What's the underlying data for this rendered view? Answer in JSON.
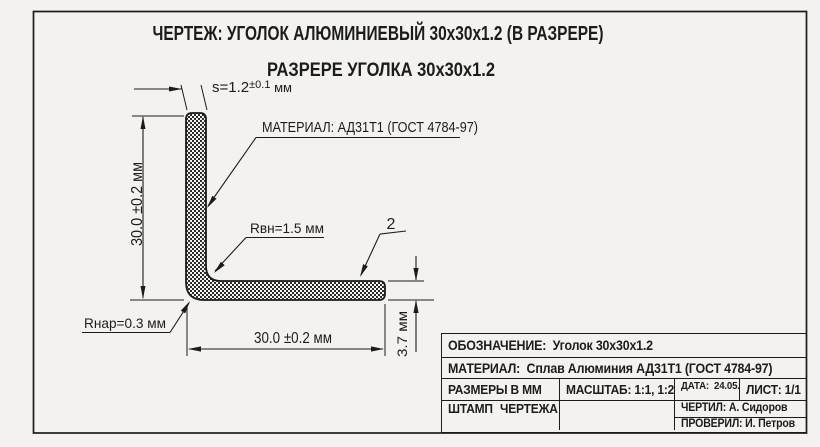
{
  "titles": {
    "line1": "ЧЕРТЕЖ: УГОЛОК АЛЮМИНИЕВЫЙ 30х30х1.2 (В РАЗРЕРЕ)",
    "line2": "РАЗРЕРЕ УГОЛКА 30х30х1.2"
  },
  "dims": {
    "thickness": {
      "main": "s=1.2",
      "tol": "±0.1",
      "unit": " мм"
    },
    "material_note": "МАТЕРИАЛ: АД31Т1 (ГОСТ 4784-97)",
    "height": "30.0 ±0.2 мм",
    "width": "30.0 ±0.2 мм",
    "inner_radius": "Rвн=1.5 мм",
    "outer_radius": "Rнар=0.3 мм",
    "end_thickness": "3.7 мм",
    "item_number": "2"
  },
  "title_block": {
    "designation_label": "ОБОЗНАЧЕНИЕ:",
    "designation_value": "Уголок 30х30х1.2",
    "material_label": "МАТЕРИАЛ:",
    "material_value": "Сплав Алюминия АД31Т1 (ГОСТ 4784-97)",
    "units": "РАЗМЕРЫ В ММ",
    "scale": "МАСШТАБ: 1:1, 1:2",
    "date_label": "ДАТА:",
    "date_value": "24.05.2024",
    "sheet": "ЛИСТ: 1/1",
    "stamp_line1": "ШТАМП",
    "stamp_line2": "ЧЕРТЕЖА",
    "drawn_by": "ЧЕРТИЛ: А. Сидоров",
    "checked_by": "ПРОВЕРИЛ: И. Петров"
  },
  "colors": {
    "ink": "#1c1c1c",
    "paper": "#f3f2ee",
    "hatch": "#2b2b2b"
  }
}
